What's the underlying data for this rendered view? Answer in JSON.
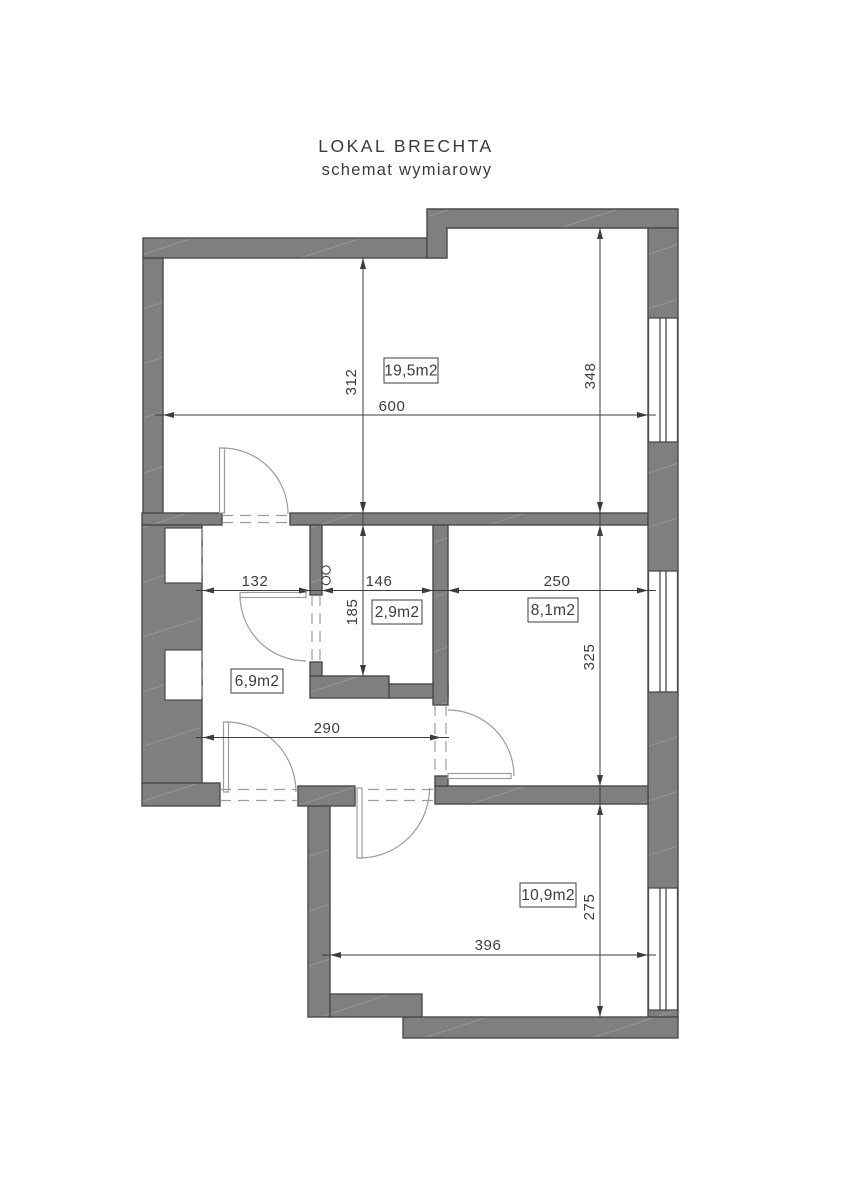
{
  "title": {
    "line1": "LOKAL BRECHTA",
    "line2": "schemat wymiarowy"
  },
  "rooms": [
    {
      "name": "room-19-5",
      "area_label": "19,5m2"
    },
    {
      "name": "room-2-9",
      "area_label": "2,9m2"
    },
    {
      "name": "room-8-1",
      "area_label": "8,1m2"
    },
    {
      "name": "room-6-9",
      "area_label": "6,9m2"
    },
    {
      "name": "room-10-9",
      "area_label": "10,9m2"
    }
  ],
  "dims": {
    "d312": "312",
    "d348": "348",
    "d600": "600",
    "d132": "132",
    "d146": "146",
    "d250": "250",
    "d185": "185",
    "d290": "290",
    "d325": "325",
    "d396": "396",
    "d275": "275"
  },
  "icons": {
    "riser_icon": "double-circle"
  },
  "colors": {
    "wall_fill": "#7f7f7f",
    "wall_hatch": "#949494",
    "wall_outline": "#4a4a4a",
    "dim_line": "#3d3d3d",
    "text": "#3c3c3c",
    "door_line": "#9c9c9c",
    "background": "#ffffff"
  }
}
